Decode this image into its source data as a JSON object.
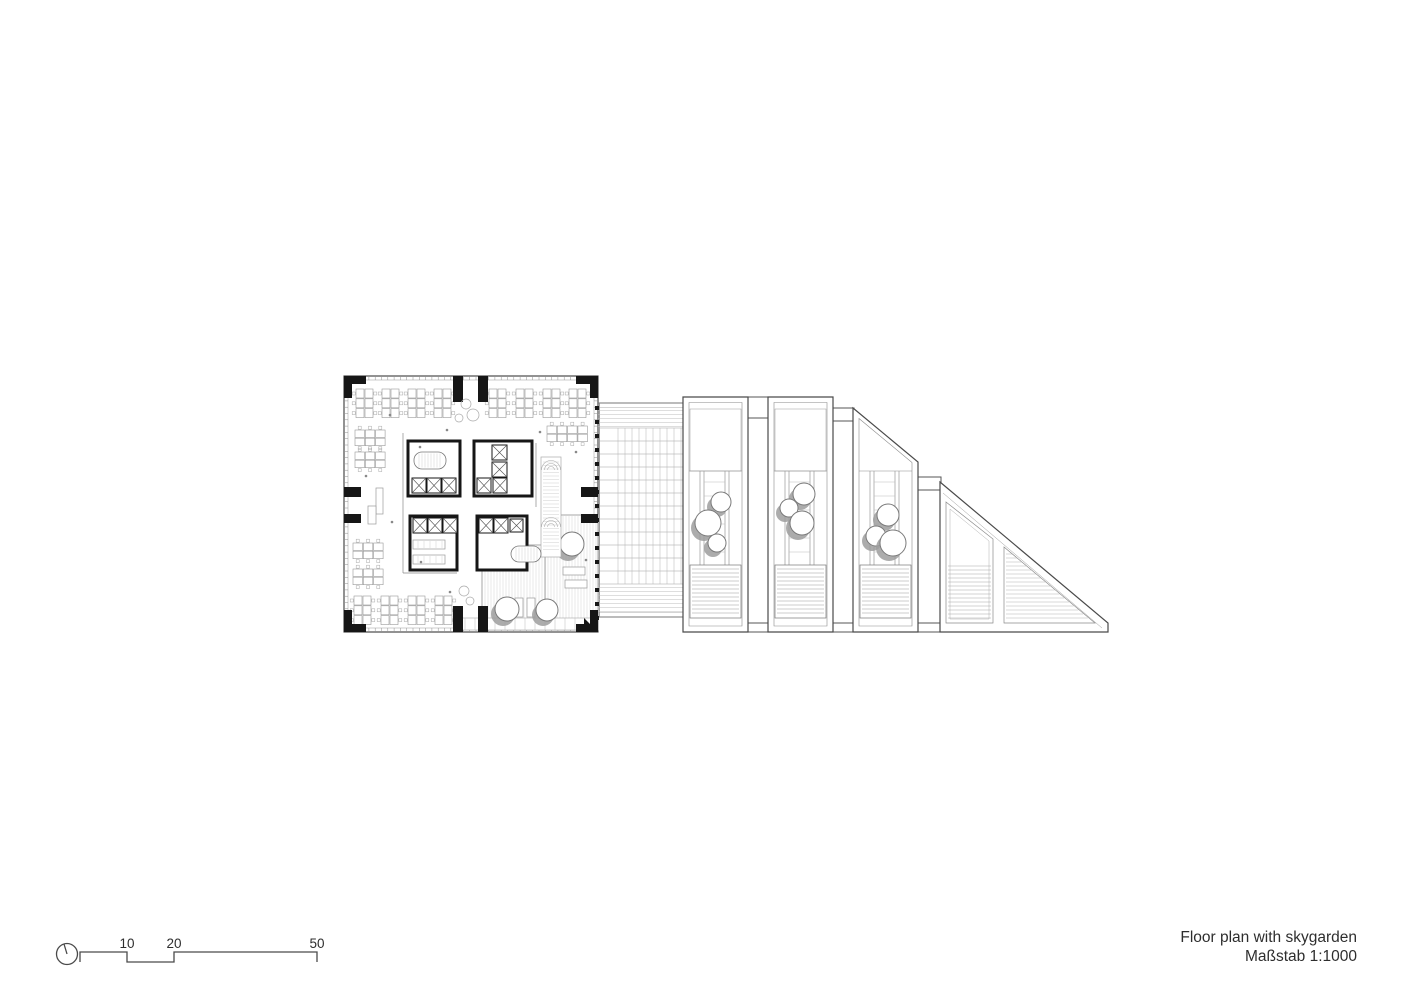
{
  "title_block": {
    "line1": "Floor plan with skygarden",
    "line2": "Maßstab 1:1000"
  },
  "scale_bar": {
    "labels": [
      "10",
      "20",
      "50"
    ]
  },
  "colors": {
    "wall": "#161616",
    "outline": "#4a4a4a",
    "line": "#555555",
    "mid": "#888888",
    "fine": "#aaaaaa",
    "finer": "#cfcfcf",
    "desk": "#9a9a9a",
    "shadow": "#9d9d9d",
    "text": "#2e2e2e"
  },
  "drawing": {
    "canvas": {
      "w": 1414,
      "h": 1000
    },
    "plan": {
      "outer": [
        344,
        376,
        254,
        256
      ],
      "corner_blocks": [
        [
          344,
          376,
          22,
          8
        ],
        [
          344,
          376,
          8,
          22
        ],
        [
          576,
          376,
          22,
          8
        ],
        [
          590,
          376,
          8,
          22
        ],
        [
          344,
          624,
          22,
          8
        ],
        [
          344,
          610,
          8,
          22
        ],
        [
          576,
          624,
          22,
          8
        ],
        [
          590,
          610,
          8,
          22
        ]
      ],
      "wall_stubs": [
        [
          453,
          376,
          10,
          26
        ],
        [
          478,
          376,
          10,
          26
        ],
        [
          453,
          606,
          10,
          26
        ],
        [
          478,
          606,
          10,
          26
        ],
        [
          344,
          487,
          17,
          10
        ],
        [
          344,
          514,
          17,
          9
        ],
        [
          581,
          487,
          17,
          10
        ],
        [
          581,
          514,
          17,
          9
        ]
      ],
      "corner_wedge": "584,618 598,632 584,632",
      "core_blocks": [
        [
          408,
          441,
          52,
          55
        ],
        [
          474,
          441,
          58,
          55
        ],
        [
          410,
          516,
          47,
          54
        ],
        [
          477,
          516,
          50,
          54
        ]
      ],
      "elevators": [
        [
          412,
          478,
          14,
          15
        ],
        [
          427,
          478,
          14,
          15
        ],
        [
          442,
          478,
          14,
          15
        ],
        [
          492,
          445,
          15,
          15
        ],
        [
          492,
          462,
          15,
          15
        ],
        [
          477,
          478,
          14,
          15
        ],
        [
          493,
          478,
          14,
          15
        ],
        [
          413,
          518,
          14,
          15
        ],
        [
          428,
          518,
          14,
          15
        ],
        [
          443,
          518,
          14,
          15
        ],
        [
          479,
          518,
          14,
          15
        ],
        [
          494,
          518,
          14,
          15
        ],
        [
          510,
          519,
          13,
          13
        ]
      ],
      "stairs": [
        [
          414,
          452,
          32,
          17
        ],
        [
          511,
          546,
          30,
          16
        ]
      ],
      "pantries": [
        [
          413,
          540,
          32,
          9
        ],
        [
          413,
          555,
          32,
          9
        ]
      ],
      "thin_lines": [
        [
          403,
          433,
          403,
          573
        ],
        [
          536,
          443,
          536,
          507
        ],
        [
          403,
          573,
          457,
          573
        ]
      ],
      "ramp": {
        "rect": [
          541,
          457,
          20,
          100
        ],
        "cx": 551,
        "arc_cys": [
          470,
          527
        ]
      },
      "terrace": {
        "decks": [
          [
            545,
            515,
            53,
            115
          ],
          [
            482,
            545,
            63,
            85
          ]
        ],
        "paver_band": [
          455,
          618,
          143,
          12
        ],
        "trees": [
          [
            572,
            544,
            12
          ],
          [
            507,
            609,
            12
          ],
          [
            547,
            610,
            11
          ]
        ],
        "loungers": [
          [
            563,
            567,
            22,
            8
          ],
          [
            565,
            580,
            22,
            8
          ],
          [
            515,
            598,
            8,
            19
          ],
          [
            527,
            598,
            8,
            19
          ]
        ]
      },
      "desk_clusters_v": [
        [
          356,
          389
        ],
        [
          382,
          389
        ],
        [
          408,
          389
        ],
        [
          434,
          389
        ],
        [
          489,
          389
        ],
        [
          516,
          389
        ],
        [
          543,
          389
        ],
        [
          569,
          389
        ],
        [
          354,
          596
        ],
        [
          381,
          596
        ],
        [
          408,
          596
        ],
        [
          435,
          596
        ]
      ],
      "desk_clusters_h": [
        [
          355,
          430,
          3
        ],
        [
          355,
          452,
          3
        ],
        [
          353,
          543,
          3
        ],
        [
          353,
          569,
          3
        ],
        [
          547,
          426,
          4
        ]
      ],
      "tables": [
        [
          376,
          488,
          7,
          26
        ],
        [
          368,
          506,
          8,
          18
        ]
      ],
      "entry_circles": [
        [
          466,
          404,
          5
        ],
        [
          473,
          415,
          6
        ],
        [
          459,
          418,
          4
        ],
        [
          464,
          591,
          5
        ],
        [
          470,
          601,
          4
        ]
      ],
      "dots": [
        [
          390,
          415
        ],
        [
          420,
          447
        ],
        [
          447,
          430
        ],
        [
          392,
          522
        ],
        [
          421,
          562
        ],
        [
          450,
          592
        ],
        [
          540,
          432
        ],
        [
          576,
          452
        ],
        [
          366,
          476
        ],
        [
          586,
          560
        ]
      ]
    },
    "link": {
      "x1": 598,
      "x2": 683,
      "top": 403,
      "bottom": 617,
      "grid": {
        "x1": 618,
        "x2": 681,
        "y1": 428,
        "y2": 584,
        "vstep": 7,
        "hstep": 13
      },
      "band_step": 4,
      "ticks_x": 595,
      "ticks_step": 14
    },
    "connectors": [
      [
        748,
        397,
        21,
        21
      ],
      [
        833,
        408,
        21,
        13
      ],
      [
        918,
        477,
        23,
        13
      ],
      [
        748,
        623,
        21,
        9
      ],
      [
        833,
        623,
        21,
        9
      ],
      [
        918,
        623,
        22,
        9
      ]
    ],
    "modules": [
      {
        "x": 683,
        "w": 65,
        "top_l": 397,
        "top_r": 397,
        "trees": [
          [
            721,
            502,
            10
          ],
          [
            708,
            523,
            13
          ],
          [
            717,
            543,
            9
          ]
        ]
      },
      {
        "x": 768,
        "w": 65,
        "top_l": 397,
        "top_r": 397,
        "trees": [
          [
            804,
            494,
            11
          ],
          [
            789,
            508,
            9
          ],
          [
            802,
            523,
            12
          ]
        ]
      },
      {
        "x": 853,
        "w": 65,
        "top_l": 408,
        "top_r": 462,
        "trees": [
          [
            888,
            515,
            11
          ],
          [
            876,
            536,
            10
          ],
          [
            893,
            543,
            13
          ]
        ]
      }
    ],
    "module_bottom": 632,
    "garden_top": 471,
    "louver_top": 565,
    "louver_bottom": 618,
    "triangle_block": {
      "outer": "940,482 1108,623 1108,632 940,632",
      "hyp_inner": [
        943,
        493,
        1102,
        628
      ],
      "inner_pent": "946,502 993,539 993,623 946,623",
      "inner_pent2": "950,509 989,541 989,619 950,619",
      "tri": "1004,547 1095,623 1004,623"
    }
  }
}
